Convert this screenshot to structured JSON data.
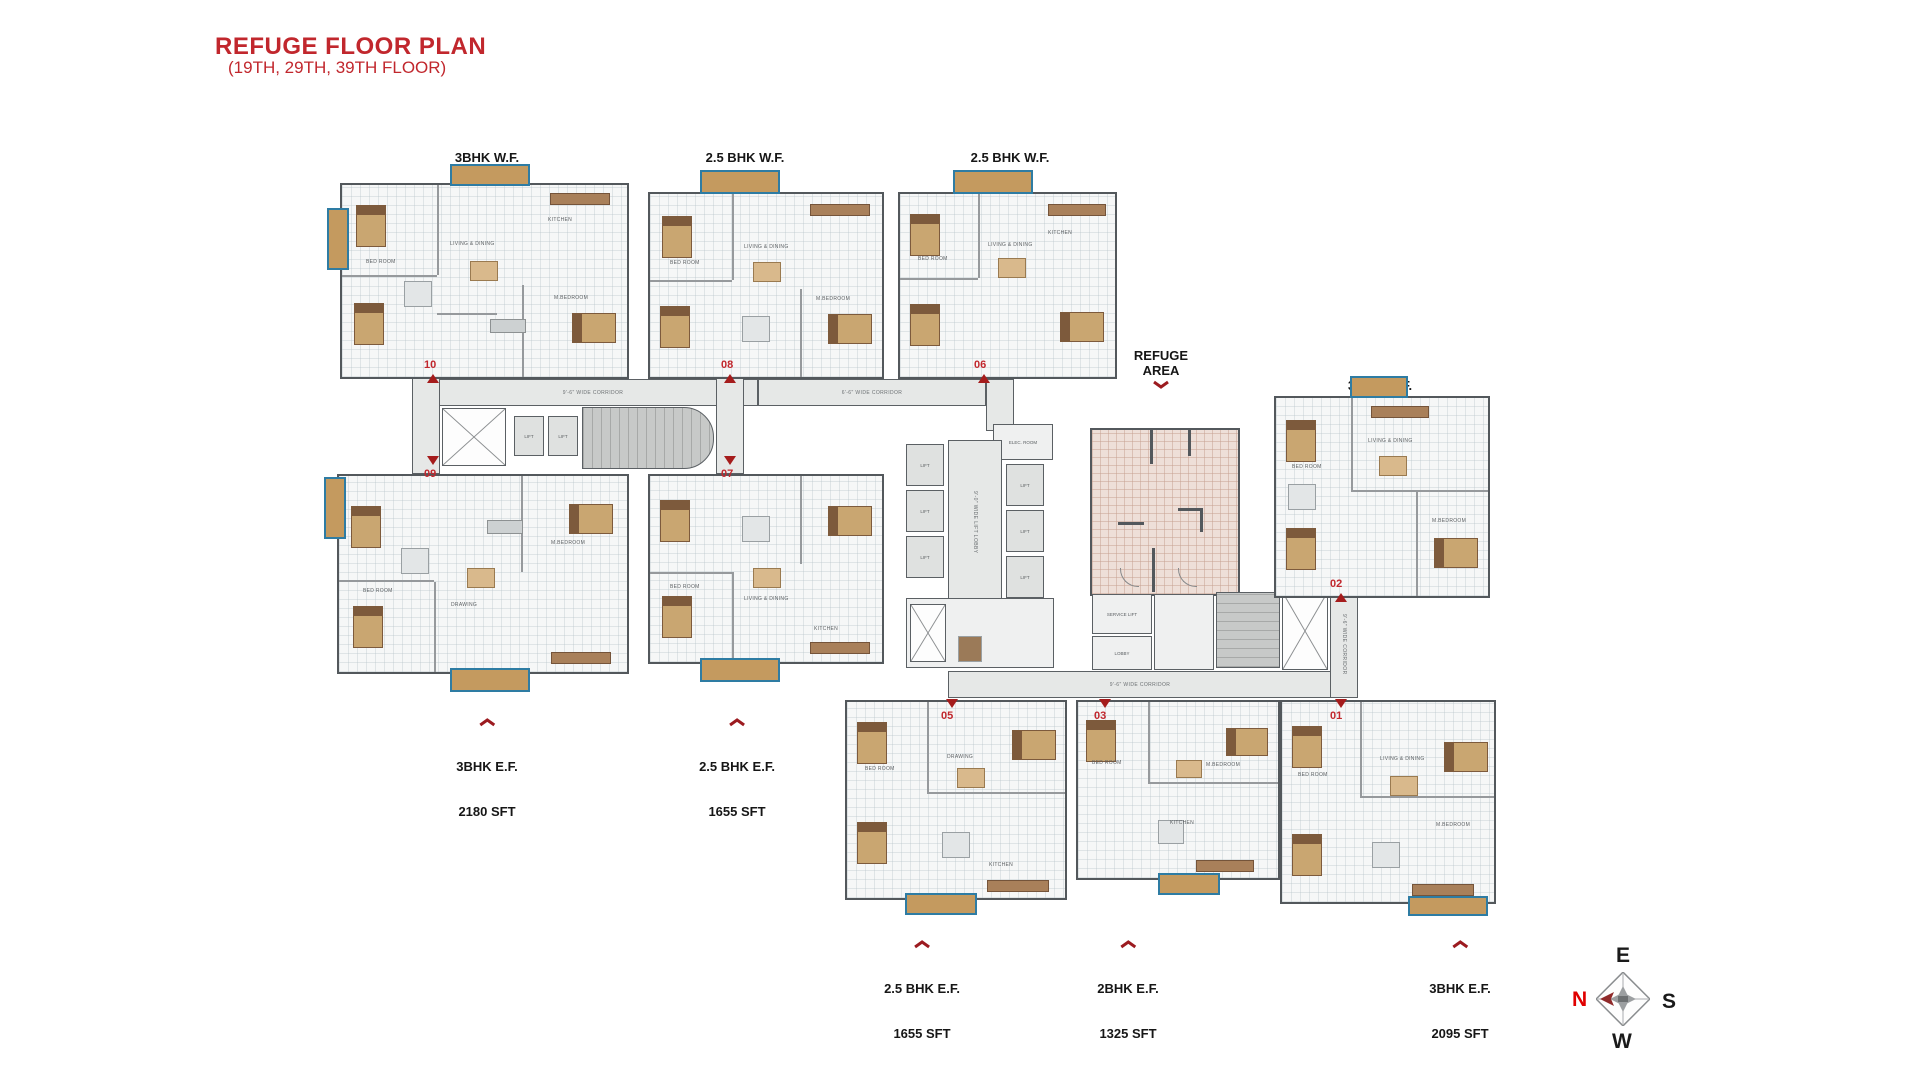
{
  "title": {
    "main": "REFUGE FLOOR PLAN",
    "sub": "(19TH, 29TH, 39TH FLOOR)"
  },
  "unit_labels": [
    {
      "name": "3BHK W.F.",
      "area": "2180 SFT",
      "arrow": "down"
    },
    {
      "name": "2.5 BHK W.F.",
      "area": "1655 SFT",
      "arrow": "down"
    },
    {
      "name": "2.5 BHK W.F.",
      "area": "1655 SFT",
      "arrow": "down"
    },
    {
      "name": "REFUGE AREA",
      "area": "",
      "arrow": "down"
    },
    {
      "name": "3BHK W.F.",
      "area": "2095 SFT",
      "arrow": "down"
    },
    {
      "name": "3BHK E.F.",
      "area": "2180 SFT",
      "arrow": "up"
    },
    {
      "name": "2.5 BHK E.F.",
      "area": "1655 SFT",
      "arrow": "up"
    },
    {
      "name": "2.5 BHK E.F.",
      "area": "1655 SFT",
      "arrow": "up"
    },
    {
      "name": "2BHK E.F.",
      "area": "1325 SFT",
      "arrow": "up"
    },
    {
      "name": "3BHK E.F.",
      "area": "2095 SFT",
      "arrow": "up"
    }
  ],
  "markers": {
    "u10": "10",
    "u09": "09",
    "u08": "08",
    "u07": "07",
    "u06": "06",
    "u05": "05",
    "u03": "03",
    "u02": "02",
    "u01": "01"
  },
  "plan_texts": {
    "corridor_96": "9'-6\" WIDE CORRIDOR",
    "corridor_66": "6'-6\" WIDE CORRIDOR",
    "lift": "LIFT",
    "lift_lobby": "9'-0\" WIDE LIFT LOBBY",
    "elec_room": "ELEC. ROOM",
    "service_lift": "SERVICE LIFT",
    "lobby": "LOBBY"
  },
  "room_labels": [
    "BED ROOM",
    "LIVING & DINING",
    "KITCHEN",
    "M.BEDROOM",
    "DRAWING",
    "TOILET"
  ],
  "compass": {
    "e": "E",
    "s": "S",
    "w": "W",
    "n": "N"
  },
  "colors": {
    "accent_red": "#c1272d",
    "marker_red": "#a51c1c",
    "balcony_blue": "#2e7ca3",
    "balcony_tan": "#c49a5f",
    "refuge_pink": "#eedfd8",
    "corridor_gray": "#e6e8e7",
    "stair_gray": "#c7c9c8",
    "wall": "#53585c"
  }
}
